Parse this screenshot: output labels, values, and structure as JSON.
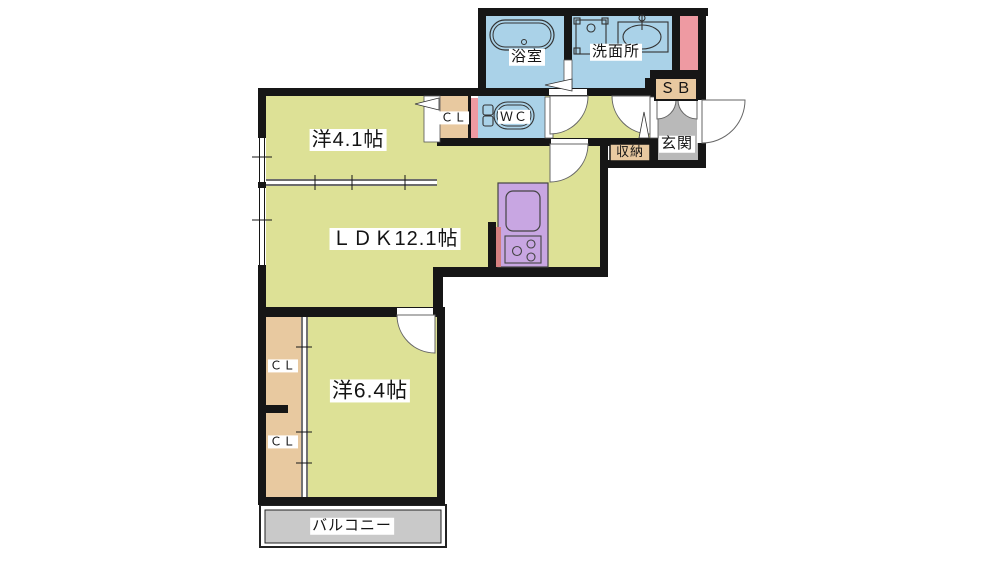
{
  "plan": {
    "type": "apartment-floor-plan",
    "labels": {
      "bathroom": "浴室",
      "washroom": "洗面所",
      "shoe_box": "ＳＢ",
      "entrance": "玄関",
      "storage": "収納",
      "toilet": "ＷＣ",
      "closet_upper": "ＣＬ",
      "closet_middle": "ＣＬ",
      "closet_lower": "ＣＬ",
      "western_room_small": "洋4.1帖",
      "ldk": "ＬＤＫ12.1帖",
      "western_room_large": "洋6.4帖",
      "balcony": "バルコニー"
    },
    "areas_tatami": {
      "western_room_small": 4.1,
      "ldk": 12.1,
      "western_room_large": 6.4
    }
  },
  "palette": {
    "room_yellow": "#dde196",
    "water_blue": "#aad2e8",
    "closet_tan": "#e8c9a0",
    "accent_pink": "#ee9aa2",
    "partition_red": "#d5807f",
    "kitchen_purple": "#c8a6e2",
    "entry_gray": "#b9b9b9",
    "balcony_gray": "#c9c9c9",
    "wall_black": "#161616"
  }
}
